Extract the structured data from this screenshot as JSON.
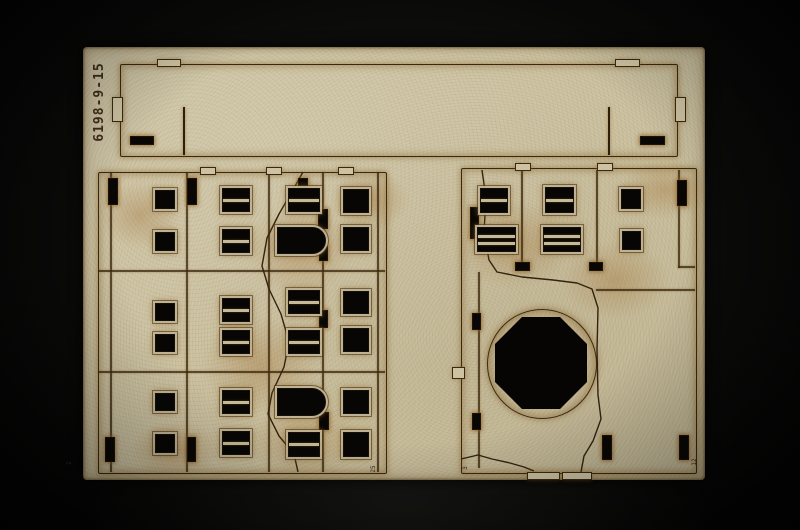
{
  "photo": {
    "subject": "Laser-cut MDF terrain-kit sheet with two ruined building facade pieces and a long wall strip, photographed on a black backdrop",
    "part_number": "6198-9-15",
    "corner_marks": [
      {
        "text": "2",
        "x": 70,
        "y": 463
      },
      {
        "text": "25",
        "x": 374,
        "y": 469
      },
      {
        "text": "3",
        "x": 466,
        "y": 468
      },
      {
        "text": "12",
        "x": 695,
        "y": 462
      }
    ],
    "colors": {
      "backdrop": "#0a0a09",
      "mdf": "#cdc3a2",
      "burn_halo": "#8a6426",
      "cut_line": "#3a2812",
      "cutout_hole": "#070604"
    },
    "sheet_rect": [
      83,
      47,
      622,
      433
    ]
  },
  "pieces": {
    "top-wall-strip": {
      "outline": [
        120,
        64,
        556,
        91
      ],
      "tabs": [
        [
          157,
          59,
          22,
          6
        ],
        [
          615,
          59,
          23,
          6
        ],
        [
          112,
          97,
          9,
          23
        ],
        [
          675,
          97,
          9,
          23
        ]
      ],
      "slits": [
        [
          183,
          107,
          2,
          48
        ],
        [
          608,
          107,
          2,
          48
        ]
      ],
      "slots": [
        [
          130,
          136,
          22,
          7
        ],
        [
          640,
          136,
          23,
          7
        ]
      ]
    },
    "left-facade": {
      "outline": [
        98,
        172,
        287,
        300
      ],
      "tabs": [
        [
          200,
          167,
          14,
          6
        ],
        [
          266,
          167,
          14,
          6
        ],
        [
          338,
          167,
          14,
          6
        ]
      ],
      "hlines": [
        [
          98,
          270,
          287,
          2
        ],
        [
          98,
          371,
          287,
          2
        ]
      ],
      "vlines": [
        [
          110,
          172,
          2,
          300
        ],
        [
          186,
          172,
          2,
          300
        ],
        [
          268,
          172,
          2,
          300
        ],
        [
          322,
          172,
          2,
          300
        ],
        [
          377,
          172,
          2,
          300
        ]
      ],
      "slots": [
        [
          108,
          178,
          8,
          25
        ],
        [
          187,
          178,
          8,
          25
        ],
        [
          298,
          178,
          8,
          25
        ],
        [
          318,
          209,
          8,
          18
        ],
        [
          319,
          246,
          7,
          13
        ],
        [
          319,
          310,
          7,
          16
        ],
        [
          319,
          412,
          8,
          16
        ],
        [
          105,
          437,
          8,
          23
        ],
        [
          187,
          437,
          7,
          23
        ]
      ],
      "windows": [
        {
          "t": "square",
          "r": [
            155,
            190,
            18,
            17
          ]
        },
        {
          "t": "square",
          "r": [
            155,
            232,
            18,
            17
          ]
        },
        {
          "t": "square",
          "r": [
            155,
            303,
            18,
            16
          ]
        },
        {
          "t": "square",
          "r": [
            155,
            334,
            18,
            16
          ]
        },
        {
          "t": "square",
          "r": [
            155,
            393,
            18,
            16
          ]
        },
        {
          "t": "square",
          "r": [
            155,
            434,
            18,
            17
          ]
        },
        {
          "t": "pane2",
          "r": [
            222,
            188,
            26,
            22
          ]
        },
        {
          "t": "pane2",
          "r": [
            222,
            229,
            26,
            22
          ]
        },
        {
          "t": "pane2",
          "r": [
            222,
            298,
            26,
            22
          ]
        },
        {
          "t": "pane2",
          "r": [
            222,
            330,
            26,
            22
          ]
        },
        {
          "t": "pane2",
          "r": [
            222,
            390,
            26,
            22
          ]
        },
        {
          "t": "pane2",
          "r": [
            222,
            431,
            26,
            22
          ]
        },
        {
          "t": "pane2",
          "r": [
            288,
            188,
            30,
            22
          ]
        },
        {
          "t": "arch",
          "r": [
            277,
            227,
            47,
            25
          ]
        },
        {
          "t": "pane2",
          "r": [
            288,
            290,
            30,
            22
          ]
        },
        {
          "t": "pane2",
          "r": [
            288,
            330,
            30,
            22
          ]
        },
        {
          "t": "arch",
          "r": [
            277,
            388,
            47,
            26
          ]
        },
        {
          "t": "pane2",
          "r": [
            288,
            432,
            30,
            23
          ]
        },
        {
          "t": "square",
          "r": [
            343,
            189,
            24,
            22
          ]
        },
        {
          "t": "square",
          "r": [
            343,
            227,
            24,
            22
          ]
        },
        {
          "t": "square",
          "r": [
            343,
            291,
            24,
            21
          ]
        },
        {
          "t": "square",
          "r": [
            343,
            328,
            24,
            22
          ]
        },
        {
          "t": "square",
          "r": [
            343,
            390,
            24,
            22
          ]
        },
        {
          "t": "square",
          "r": [
            343,
            432,
            24,
            23
          ]
        }
      ],
      "cracks": [
        "303,172 294,188 279,214 267,238 262,266 269,289 281,314 289,342 284,367 272,393 268,414 279,436 294,454 298,472"
      ]
    },
    "right-facade": {
      "outline": [
        461,
        168,
        234,
        304
      ],
      "tabs": [
        [
          515,
          163,
          14,
          6
        ],
        [
          597,
          163,
          14,
          6
        ],
        [
          452,
          367,
          11,
          10
        ],
        [
          527,
          472,
          31,
          6
        ],
        [
          562,
          472,
          28,
          6
        ]
      ],
      "vlines": [
        [
          521,
          170,
          2,
          95
        ],
        [
          596,
          170,
          2,
          95
        ],
        [
          678,
          170,
          2,
          98
        ],
        [
          478,
          272,
          2,
          196
        ]
      ],
      "hlines": [
        [
          596,
          289,
          99,
          2
        ],
        [
          678,
          266,
          17,
          2
        ]
      ],
      "slots": [
        [
          470,
          207,
          7,
          30
        ],
        [
          677,
          180,
          8,
          24
        ],
        [
          515,
          262,
          13,
          7
        ],
        [
          589,
          262,
          12,
          7
        ],
        [
          472,
          313,
          7,
          15
        ],
        [
          472,
          413,
          7,
          15
        ],
        [
          602,
          435,
          8,
          23
        ],
        [
          679,
          435,
          8,
          23
        ]
      ],
      "windows": [
        {
          "t": "pane2",
          "r": [
            480,
            188,
            26,
            23
          ]
        },
        {
          "t": "pane3",
          "r": [
            477,
            227,
            37,
            23
          ]
        },
        {
          "t": "pane2",
          "r": [
            545,
            187,
            27,
            24
          ]
        },
        {
          "t": "pane3",
          "r": [
            543,
            227,
            36,
            23
          ]
        },
        {
          "t": "square",
          "r": [
            621,
            189,
            18,
            18
          ]
        },
        {
          "t": "square",
          "r": [
            622,
            231,
            17,
            17
          ]
        }
      ],
      "octagon": {
        "circle": [
          487,
          309,
          108,
          108
        ],
        "oct": [
          495,
          317,
          92,
          92
        ]
      },
      "cracks": [
        "482,170 486,198 484,232 489,260 497,272 522,277 553,280 577,283 592,289 598,308 597,350 598,395 601,419 593,441 584,456 581,472",
        "461,459 478,455 492,459 510,463 524,467 534,471"
      ]
    }
  }
}
